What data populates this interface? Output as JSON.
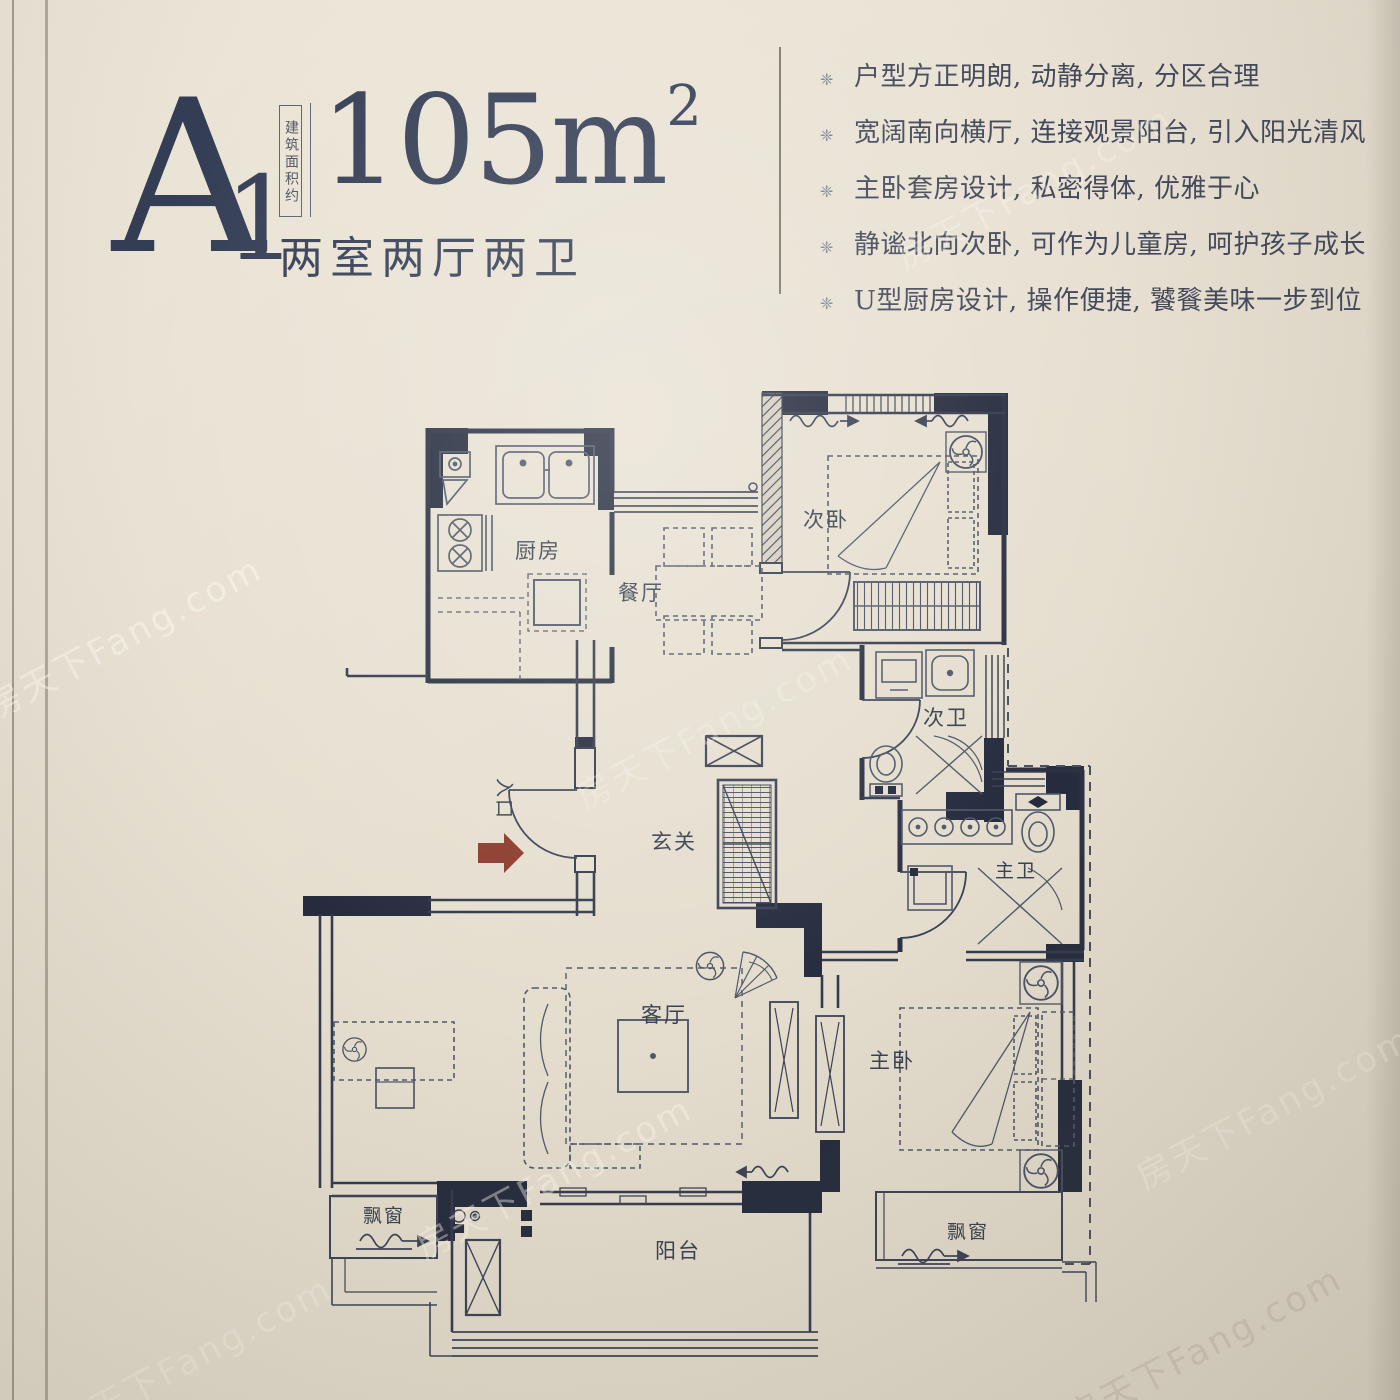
{
  "palette": {
    "paper": "#e7e0d2",
    "ink": "#2b3143",
    "title_ink": "#333d54",
    "entry_arrow": "#8b3a2b"
  },
  "header": {
    "unit_letter": "A",
    "unit_number": "1",
    "area_note": "建筑面积约",
    "area_value": "105m",
    "area_exponent": "2",
    "layout_summary": "两室两厅两卫"
  },
  "features": {
    "bullet_glyph": "❈",
    "items": [
      "户型方正明朗, 动静分离, 分区合理",
      "宽阔南向横厅, 连接观景阳台, 引入阳光清风",
      "主卧套房设计, 私密得体, 优雅于心",
      "静谧北向次卧, 可作为儿童房, 呵护孩子成长",
      "U型厨房设计, 操作便捷, 饕餮美味一步到位"
    ]
  },
  "plan": {
    "labels": {
      "kitchen": "厨房",
      "dining": "餐厅",
      "second_bedroom": "次卧",
      "second_bath": "次卫",
      "foyer": "玄关",
      "master_bath": "主卫",
      "living_room": "客厅",
      "master_bedroom": "主卧",
      "bay_window_left": "飘窗",
      "bay_window_right": "飘窗",
      "balcony": "阳台",
      "entrance": "入口"
    }
  },
  "watermark": {
    "text": "房天下Fang.com"
  }
}
